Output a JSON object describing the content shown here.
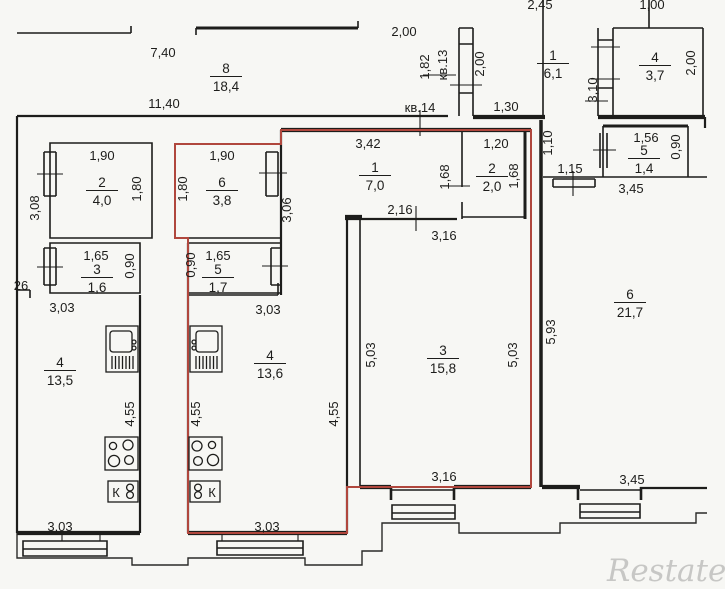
{
  "plan": {
    "type": "apartment-floor-plan",
    "width": 725,
    "height": 589
  },
  "colors": {
    "wall": "#1d1d1b",
    "red_outline": "#b0473d",
    "background": "#f7f7f4",
    "watermark": "#c7c7c5"
  },
  "watermark": {
    "text": "Restate"
  },
  "rooms": [
    {
      "number": "8",
      "area": "18,4",
      "x": 226,
      "y": 73
    },
    {
      "number": "1",
      "area": "6,1",
      "x": 553,
      "y": 60
    },
    {
      "number": "4",
      "area": "3,7",
      "x": 655,
      "y": 62
    },
    {
      "number": "2",
      "area": "4,0",
      "x": 102,
      "y": 187
    },
    {
      "number": "6",
      "area": "3,8",
      "x": 222,
      "y": 187
    },
    {
      "number": "1",
      "area": "7,0",
      "x": 375,
      "y": 172
    },
    {
      "number": "2",
      "area": "2,0",
      "x": 492,
      "y": 173
    },
    {
      "number": "5",
      "area": "1,4",
      "x": 644,
      "y": 155
    },
    {
      "number": "3",
      "area": "1,6",
      "x": 97,
      "y": 274
    },
    {
      "number": "5",
      "area": "1,7",
      "x": 218,
      "y": 274
    },
    {
      "number": "4",
      "area": "13,5",
      "x": 60,
      "y": 367
    },
    {
      "number": "4",
      "area": "13,6",
      "x": 270,
      "y": 360
    },
    {
      "number": "3",
      "area": "15,8",
      "x": 443,
      "y": 355
    },
    {
      "number": "6",
      "area": "21,7",
      "x": 630,
      "y": 299
    }
  ],
  "labels": {
    "horizontal": [
      {
        "text": "7,40",
        "x": 163,
        "y": 57
      },
      {
        "text": "11,40",
        "x": 164,
        "y": 108
      },
      {
        "text": "2,00",
        "x": 404,
        "y": 36
      },
      {
        "text": "2,45",
        "x": 540,
        "y": 9
      },
      {
        "text": "1,00",
        "x": 652,
        "y": 9
      },
      {
        "text": "кв.14",
        "x": 420,
        "y": 112,
        "name": "apartment-label-kv14"
      },
      {
        "text": "1,30",
        "x": 506,
        "y": 111
      },
      {
        "text": "1,90",
        "x": 102,
        "y": 160
      },
      {
        "text": "1,90",
        "x": 222,
        "y": 160
      },
      {
        "text": "3,42",
        "x": 368,
        "y": 148
      },
      {
        "text": "1,20",
        "x": 496,
        "y": 148
      },
      {
        "text": "1,56",
        "x": 646,
        "y": 142
      },
      {
        "text": "1,15",
        "x": 570,
        "y": 173
      },
      {
        "text": "3,45",
        "x": 631,
        "y": 193
      },
      {
        "text": "2,16",
        "x": 400,
        "y": 214
      },
      {
        "text": "3,16",
        "x": 444,
        "y": 240
      },
      {
        "text": "1,65",
        "x": 96,
        "y": 260
      },
      {
        "text": "1,65",
        "x": 218,
        "y": 260
      },
      {
        "text": "26",
        "x": 21,
        "y": 290
      },
      {
        "text": "3,03",
        "x": 62,
        "y": 312
      },
      {
        "text": "3,03",
        "x": 268,
        "y": 314
      },
      {
        "text": "3,16",
        "x": 444,
        "y": 481
      },
      {
        "text": "3,45",
        "x": 632,
        "y": 484
      },
      {
        "text": "3,03",
        "x": 60,
        "y": 531
      },
      {
        "text": "3,03",
        "x": 267,
        "y": 531
      },
      {
        "text": "К",
        "x": 116,
        "y": 497,
        "name": "kitchen-sink-label"
      },
      {
        "text": "К",
        "x": 212,
        "y": 497,
        "name": "kitchen-sink-label"
      }
    ],
    "vertical": [
      {
        "text": "1,82",
        "x": 429,
        "y": 67
      },
      {
        "text": "кв.13",
        "x": 447,
        "y": 65,
        "name": "apartment-label-kv13"
      },
      {
        "text": "2,00",
        "x": 484,
        "y": 64
      },
      {
        "text": "3,10",
        "x": 597,
        "y": 90
      },
      {
        "text": "2,00",
        "x": 695,
        "y": 63
      },
      {
        "text": "1,10",
        "x": 552,
        "y": 143
      },
      {
        "text": "0,90",
        "x": 680,
        "y": 147
      },
      {
        "text": "1,80",
        "x": 141,
        "y": 189
      },
      {
        "text": "1,80",
        "x": 187,
        "y": 189
      },
      {
        "text": "3,08",
        "x": 39,
        "y": 208
      },
      {
        "text": "3,06",
        "x": 291,
        "y": 210
      },
      {
        "text": "1,68",
        "x": 449,
        "y": 177
      },
      {
        "text": "1,68",
        "x": 518,
        "y": 176
      },
      {
        "text": "0,90",
        "x": 134,
        "y": 266
      },
      {
        "text": "0,90",
        "x": 195,
        "y": 265
      },
      {
        "text": "5,03",
        "x": 375,
        "y": 355
      },
      {
        "text": "5,03",
        "x": 517,
        "y": 355
      },
      {
        "text": "5,93",
        "x": 555,
        "y": 332
      },
      {
        "text": "4,55",
        "x": 134,
        "y": 414
      },
      {
        "text": "4,55",
        "x": 200,
        "y": 414
      },
      {
        "text": "4,55",
        "x": 338,
        "y": 414
      }
    ]
  }
}
